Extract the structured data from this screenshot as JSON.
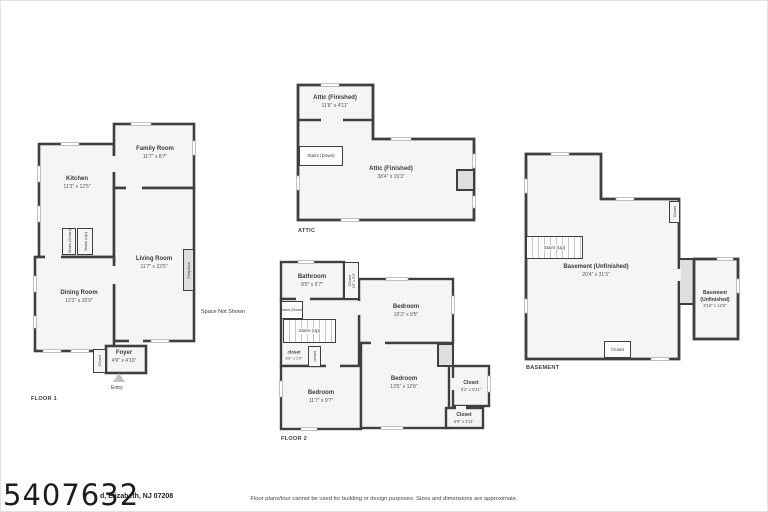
{
  "colors": {
    "wall": "#3f3f3f",
    "room_fill": "#f5f5f5",
    "shaded_fill": "#dedede",
    "background": "#ffffff"
  },
  "floor1": {
    "label": "FLOOR 1",
    "kitchen": {
      "name": "Kitchen",
      "dims": "11'3\" x 12'5\""
    },
    "family_room": {
      "name": "Family Room",
      "dims": "11'7\" x 8'7\""
    },
    "living_room": {
      "name": "Living Room",
      "dims": "11'7\" x 22'5\""
    },
    "dining_room": {
      "name": "Dining Room",
      "dims": "12'3\" x 15'9\""
    },
    "foyer": {
      "name": "Foyer",
      "dims": "4'9\" x 4'10\""
    },
    "closet": "Closet",
    "stairs_down": "Stairs (Down)",
    "stairs_up": "Stairs (Up)",
    "fireplace": "Fireplace",
    "space_not_shown": "Space Not Shown",
    "entry": "Entry"
  },
  "attic": {
    "label": "ATTIC",
    "attic_small": {
      "name": "Attic (Finished)",
      "dims": "11'8\" x 4'11\""
    },
    "attic_main": {
      "name": "Attic (Finished)",
      "dims": "38'4\" x 15'3\""
    },
    "stairs_down": "Stairs (Down)"
  },
  "floor2": {
    "label": "FLOOR 2",
    "bathroom": {
      "name": "Bathroom",
      "dims": "8'0\" x 5'7\""
    },
    "closet_top": {
      "name": "Closet",
      "dims": "2'3\" x 5'4\""
    },
    "bedroom_right": {
      "name": "Bedroom",
      "dims": "15'3\" x 9'5\""
    },
    "stairs_down": "Stairs (Down)",
    "stairs_up": "Stairs (Up)",
    "closet_small": {
      "name": "closet",
      "dims": "3'6\" x 2'9\""
    },
    "closet_mid": "closet",
    "bedroom_left": {
      "name": "Bedroom",
      "dims": "11'7\" x 9'7\""
    },
    "bedroom_center": {
      "name": "Bedroom",
      "dims": "13'5\" x 12'8\""
    },
    "closet_right": {
      "name": "Closet",
      "dims": "5'2\" x 5'11\""
    },
    "closet_bottom": {
      "name": "Closet",
      "dims": "5'9\" x 2'11\""
    }
  },
  "basement": {
    "label": "BASEMENT",
    "main": {
      "name": "Basement (Unfinished)",
      "dims": "20'4\" x 31'3\""
    },
    "side": {
      "name": "Basement",
      "name2": "(Unfinished)",
      "dims": "6'10\" x 12'8\""
    },
    "stairs_up": "Stairs (Up)",
    "closet_top": "Closet",
    "closet_bottom": "Closet"
  },
  "footer": {
    "listing_number": "5407632",
    "address": "d, Elizabeth, NJ 07208",
    "disclaimer": "Floor plans/tour cannot be used for building or design purposes. Sizes and dimensions are approximate."
  }
}
